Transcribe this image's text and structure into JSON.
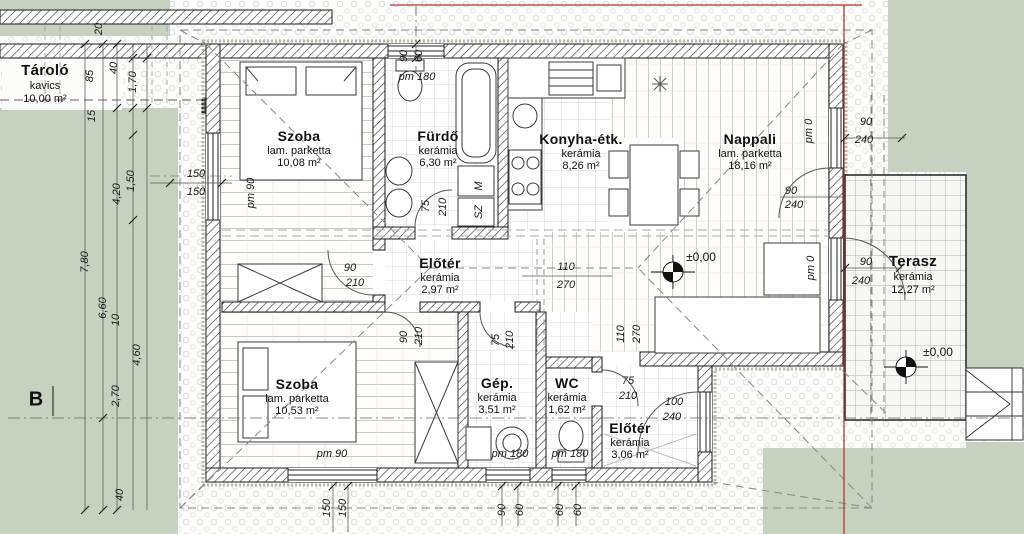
{
  "drawing": {
    "type": "architectural floor plan (ground floor)",
    "colors": {
      "lawn": "#c6d2bf",
      "wall_line": "#1a1a1a",
      "red_line": "#b03a2e",
      "grid": "#c9c9c9"
    },
    "rooms": [
      {
        "name": "Szoba",
        "floor": "lam. parketta",
        "area": "10,08 m²"
      },
      {
        "name": "Fürdő",
        "floor": "kerámia",
        "area": "6,30 m²"
      },
      {
        "name": "Konyha-étk.",
        "floor": "kerámia",
        "area": "8,26 m²"
      },
      {
        "name": "Nappali",
        "floor": "lam. parketta",
        "area": "18,16 m²"
      },
      {
        "name": "Előtér",
        "floor": "kerámia",
        "area": "2,97 m²"
      },
      {
        "name": "Szoba",
        "floor": "lam. parketta",
        "area": "10,53 m²"
      },
      {
        "name": "Gép.",
        "floor": "kerámia",
        "area": "3,51 m²"
      },
      {
        "name": "WC",
        "floor": "kerámia",
        "area": "1,62 m²"
      },
      {
        "name": "Előtér",
        "floor": "kerámia",
        "area": "3,06 m²"
      },
      {
        "name": "Terasz",
        "floor": "kerámia",
        "area": "12,27 m²"
      },
      {
        "name": "Tároló",
        "floor": "kavics",
        "area": "10,00 m²"
      }
    ],
    "levels": [
      {
        "label": "±0,00"
      },
      {
        "label": "±0,00"
      }
    ],
    "section_marker": "B",
    "dimensions": [
      {
        "t": "20",
        "x": 99,
        "y": 29,
        "r": 1
      },
      {
        "t": "85",
        "x": 90,
        "y": 76,
        "r": 1
      },
      {
        "t": "40",
        "x": 114,
        "y": 68,
        "r": 1
      },
      {
        "t": "1,70",
        "x": 133,
        "y": 82,
        "r": 1
      },
      {
        "t": "15",
        "x": 92,
        "y": 116,
        "r": 1
      },
      {
        "t": "1,50",
        "x": 131,
        "y": 181,
        "r": 1
      },
      {
        "t": "4,20",
        "x": 117,
        "y": 194,
        "r": 1
      },
      {
        "t": "7,80",
        "x": 85,
        "y": 262,
        "r": 1
      },
      {
        "t": "6,60",
        "x": 103,
        "y": 308,
        "r": 1
      },
      {
        "t": "10",
        "x": 116,
        "y": 320,
        "r": 1
      },
      {
        "t": "4,60",
        "x": 137,
        "y": 355,
        "r": 1
      },
      {
        "t": "2,70",
        "x": 116,
        "y": 396,
        "r": 1
      },
      {
        "t": "40",
        "x": 120,
        "y": 495,
        "r": 1
      },
      {
        "t": "150",
        "x": 196,
        "y": 174
      },
      {
        "t": "150",
        "x": 196,
        "y": 192
      },
      {
        "t": "90",
        "x": 404,
        "y": 56,
        "r": 1
      },
      {
        "t": "60",
        "x": 419,
        "y": 56,
        "r": 1
      },
      {
        "t": "150",
        "x": 327,
        "y": 508,
        "r": 1
      },
      {
        "t": "150",
        "x": 343,
        "y": 508,
        "r": 1
      },
      {
        "t": "90",
        "x": 502,
        "y": 510,
        "r": 1
      },
      {
        "t": "60",
        "x": 520,
        "y": 510,
        "r": 1
      },
      {
        "t": "60",
        "x": 560,
        "y": 510,
        "r": 1
      },
      {
        "t": "60",
        "x": 578,
        "y": 510,
        "r": 1
      },
      {
        "t": "90",
        "x": 866,
        "y": 122
      },
      {
        "t": "240",
        "x": 864,
        "y": 140
      },
      {
        "t": "90",
        "x": 866,
        "y": 262
      },
      {
        "t": "240",
        "x": 861,
        "y": 281
      },
      {
        "t": "90",
        "x": 791,
        "y": 191
      },
      {
        "t": "240",
        "x": 794,
        "y": 205
      },
      {
        "t": "110",
        "x": 566,
        "y": 267
      },
      {
        "t": "270",
        "x": 566,
        "y": 285
      },
      {
        "t": "110",
        "x": 621,
        "y": 334,
        "r": 1
      },
      {
        "t": "270",
        "x": 637,
        "y": 334,
        "r": 1
      },
      {
        "t": "90",
        "x": 350,
        "y": 268
      },
      {
        "t": "210",
        "x": 355,
        "y": 283
      },
      {
        "t": "75",
        "x": 426,
        "y": 206,
        "r": 1
      },
      {
        "t": "210",
        "x": 443,
        "y": 207,
        "r": 1
      },
      {
        "t": "90",
        "x": 404,
        "y": 337,
        "r": 1
      },
      {
        "t": "210",
        "x": 419,
        "y": 336,
        "r": 1
      },
      {
        "t": "75",
        "x": 496,
        "y": 340,
        "r": 1
      },
      {
        "t": "210",
        "x": 510,
        "y": 340,
        "r": 1
      },
      {
        "t": "75",
        "x": 628,
        "y": 381
      },
      {
        "t": "210",
        "x": 628,
        "y": 396
      },
      {
        "t": "100",
        "x": 674,
        "y": 402
      },
      {
        "t": "240",
        "x": 672,
        "y": 417
      },
      {
        "t": "pm 180",
        "x": 417,
        "y": 77
      },
      {
        "t": "pm 90",
        "x": 251,
        "y": 193,
        "r": 1
      },
      {
        "t": "pm 0",
        "x": 809,
        "y": 131,
        "r": 1
      },
      {
        "t": "pm 0",
        "x": 811,
        "y": 268,
        "r": 1
      },
      {
        "t": "pm 90",
        "x": 332,
        "y": 454
      },
      {
        "t": "pm 180",
        "x": 510,
        "y": 454
      },
      {
        "t": "pm 180",
        "x": 570,
        "y": 454
      },
      {
        "t": "M",
        "x": 479,
        "y": 186,
        "r": 1
      },
      {
        "t": "SZ",
        "x": 479,
        "y": 212,
        "r": 1
      }
    ]
  }
}
